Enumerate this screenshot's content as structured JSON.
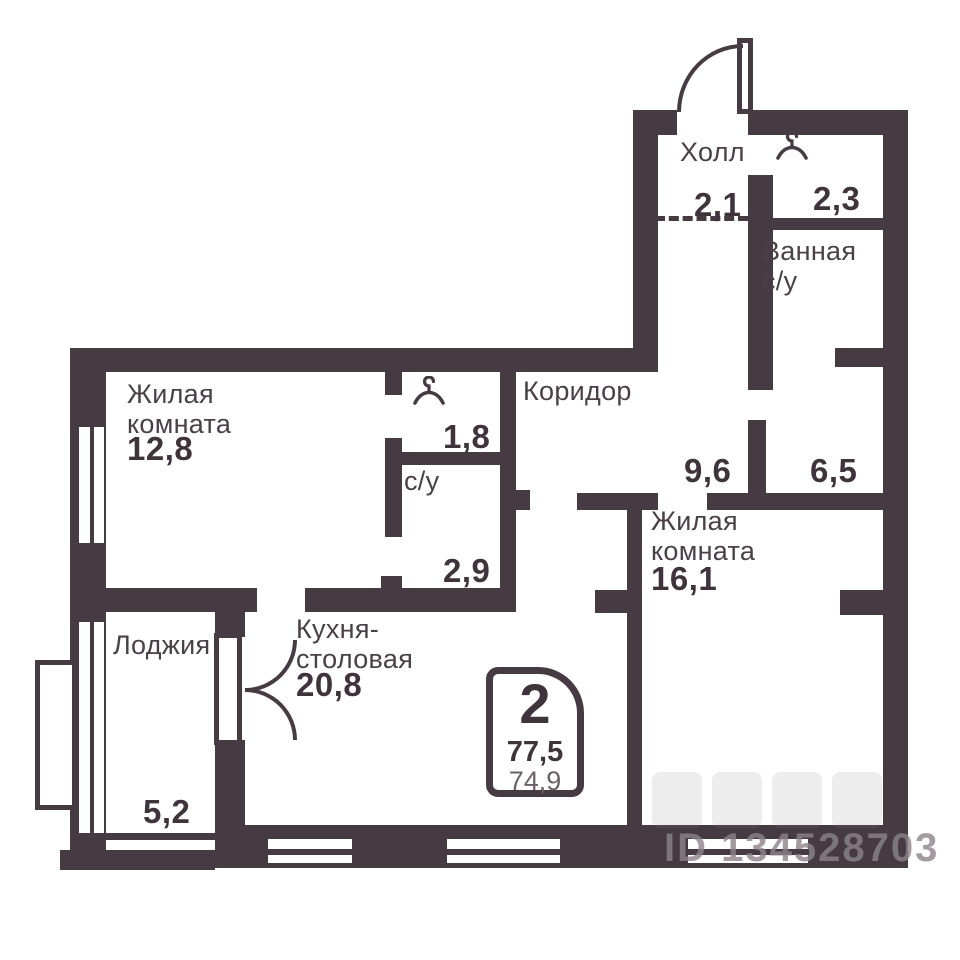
{
  "rooms": {
    "hall": {
      "name": "Холл",
      "area": "2,1"
    },
    "hall_closet": {
      "area": "2,3"
    },
    "bathroom": {
      "name_line1": "Ванная",
      "name_line2": "с/у"
    },
    "living_room_1": {
      "name_line1": "Жилая",
      "name_line2": "комната",
      "area": "12,8"
    },
    "wardrobe": {
      "area": "1,8"
    },
    "wc": {
      "name": "с/у",
      "area": "2,9"
    },
    "corridor": {
      "name": "Коридор",
      "area": "9,6"
    },
    "utility": {
      "area": "6,5"
    },
    "living_room_2": {
      "name_line1": "Жилая",
      "name_line2": "комната",
      "area": "16,1"
    },
    "kitchen_dining": {
      "name_line1": "Кухня-",
      "name_line2": "столовая",
      "area": "20,8"
    },
    "loggia": {
      "name": "Лоджия",
      "area": "5,2"
    }
  },
  "info_badge": {
    "room_count": "2",
    "area_total": "77,5",
    "area_secondary": "74,9"
  },
  "watermark": {
    "listing_id": "ID 134528703"
  },
  "colors": {
    "wall": "#463B43",
    "text": "#4A4047",
    "area_secondary": "#6B6268",
    "watermark": "#8D8389"
  }
}
